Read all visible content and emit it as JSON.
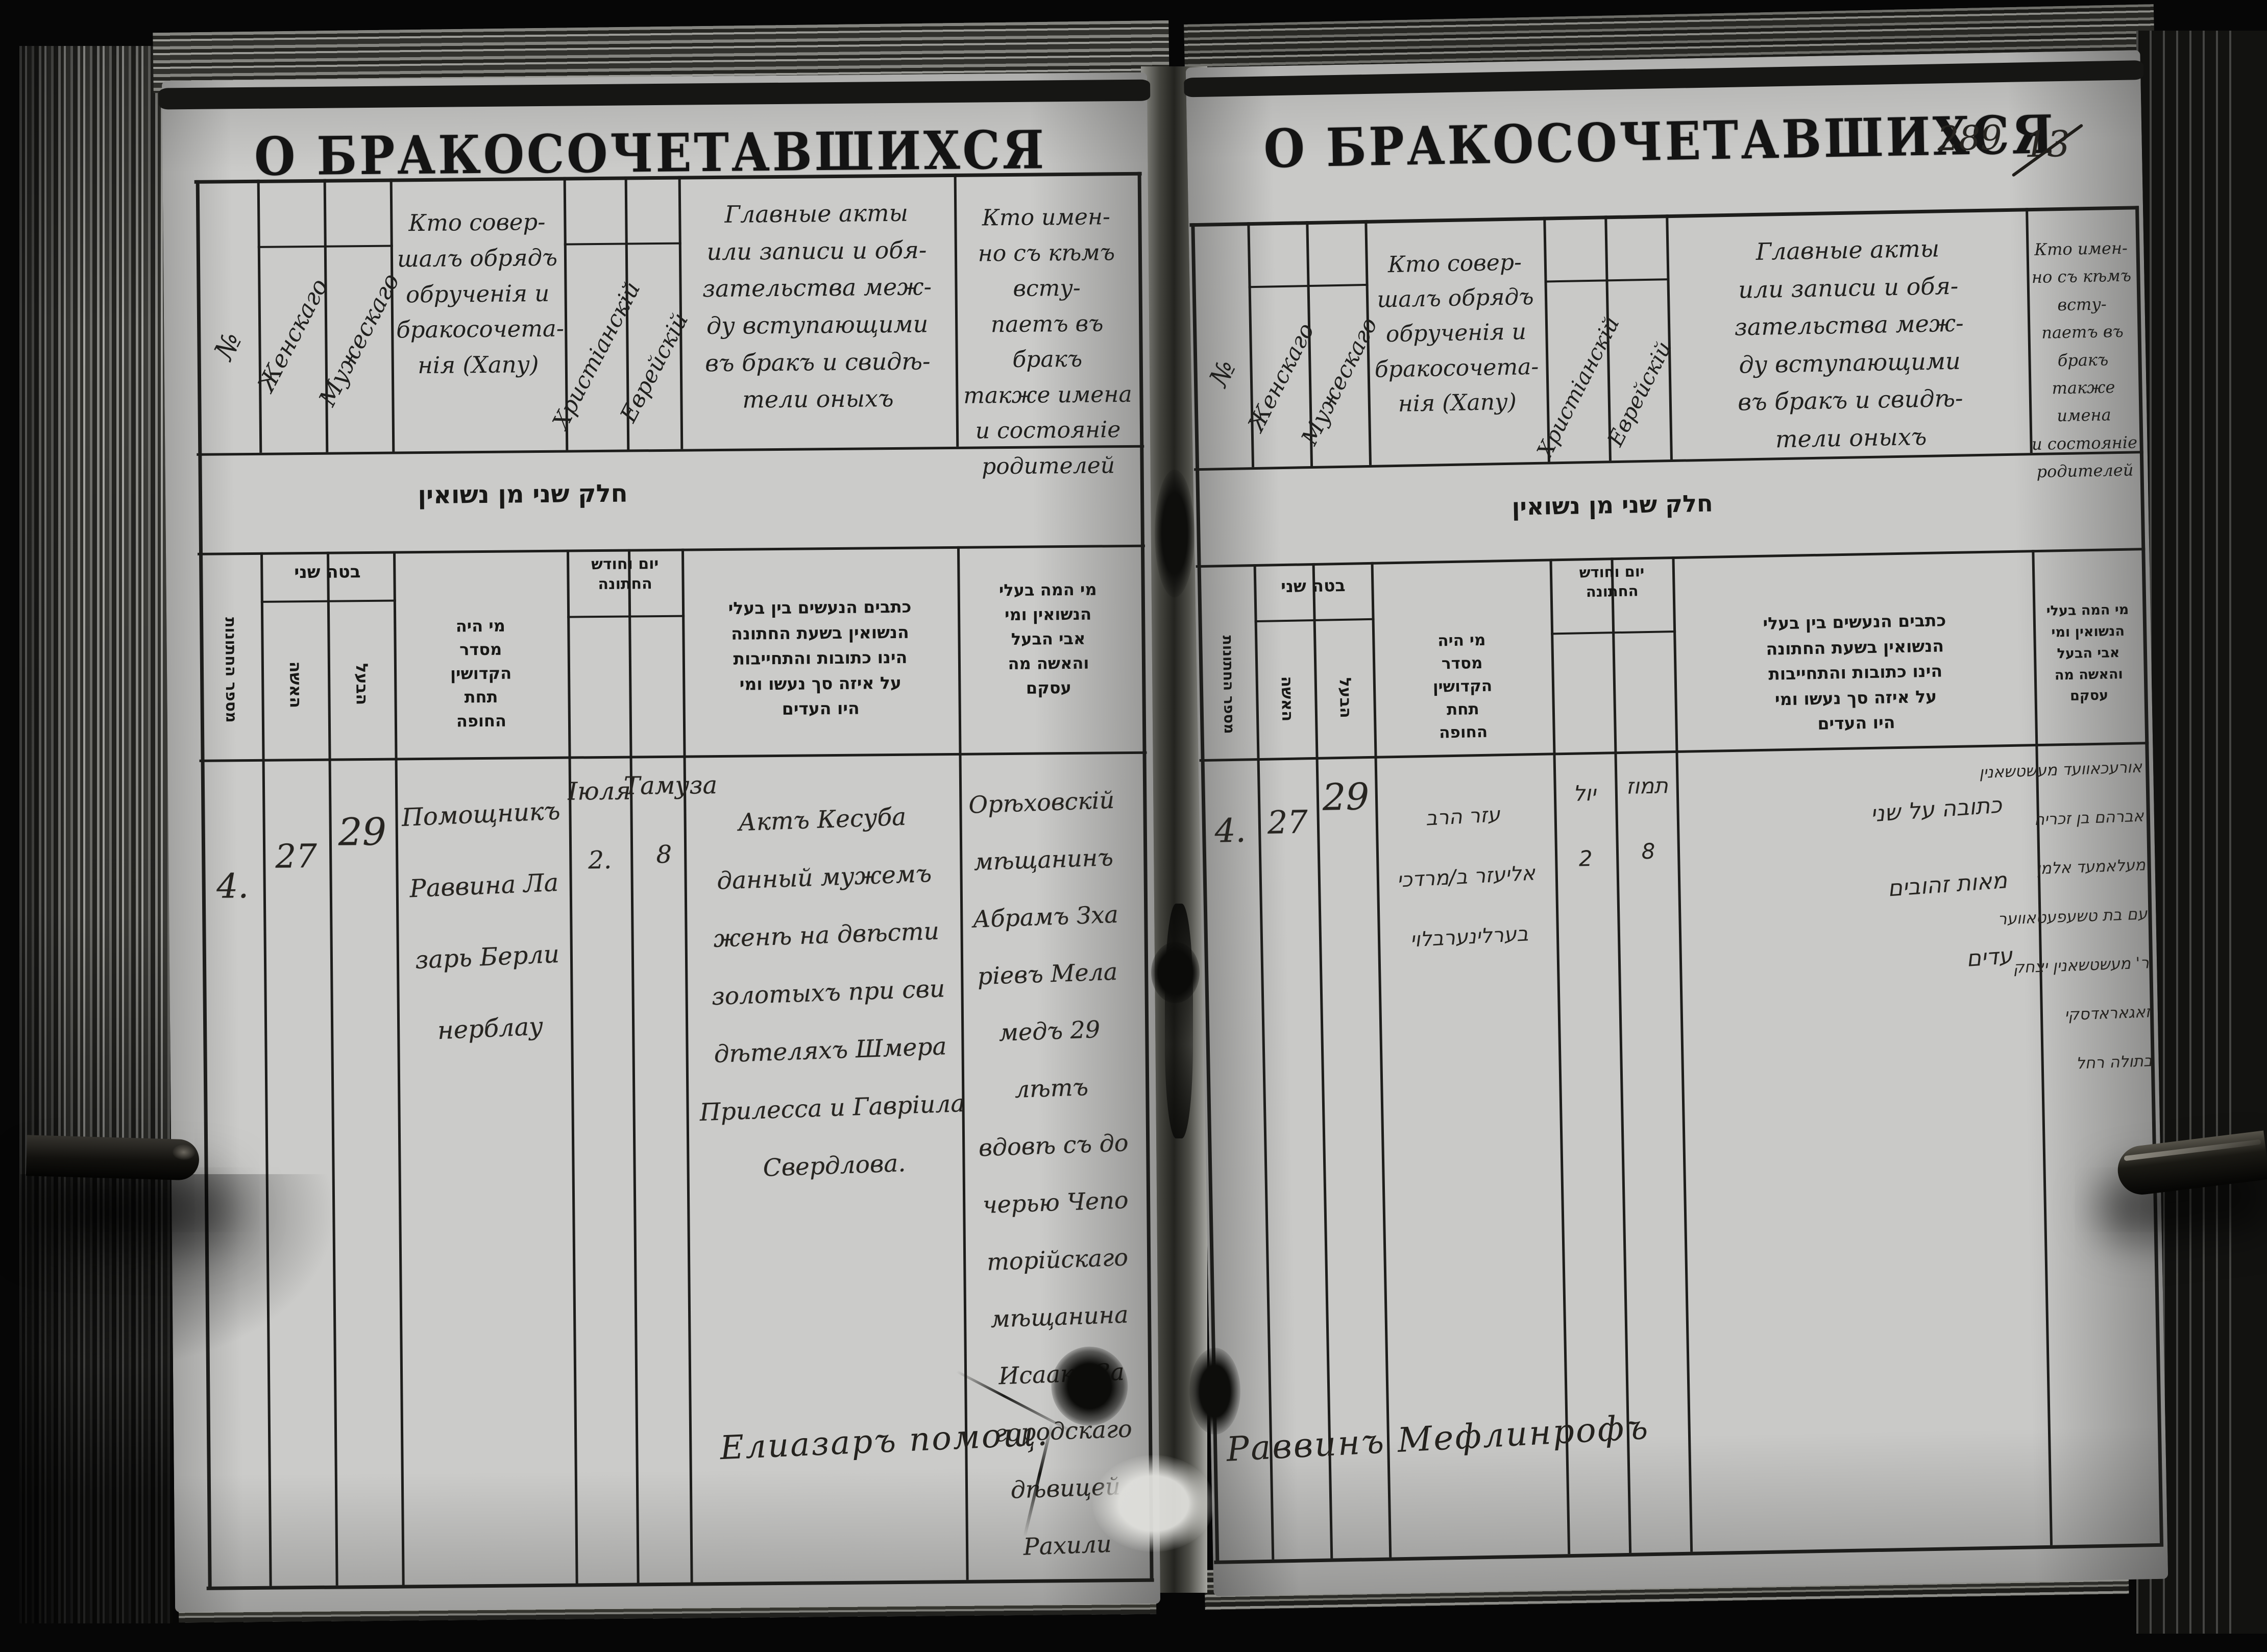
{
  "scan": {
    "title": "О БРАКОСОЧЕТАВШИХСЯ",
    "page_number": "289",
    "page_number_struck": "13"
  },
  "headers": {
    "ru": {
      "no": "№",
      "female": "Женскаго",
      "male": "Мужескаго",
      "officiant": "Кто совер-\nшалъ обрядъ\nобрученія и\nбракосочета-\nнія (Хапу)",
      "christian": "Христіанскій",
      "jewish": "Еврейскій",
      "acts": "Главные акты\nили записи и обя-\nзательства меж-\nду вступающими\nвъ бракъ и свидѣ-\nтели оныхъ",
      "who": "Кто имен-\nно съ кѣмъ всту-\nпаетъ въ бракъ\nтакже имена\nи состояніе\nродителей"
    },
    "he": {
      "band": "חלק שני מן נשואין",
      "count": "מספר החתונות",
      "age": "בטה שני",
      "wife": "האשה",
      "husband": "הבעל",
      "officiant": "מי היה\nמסדר\nהקדושין\nתחת\nהחופה",
      "date": "יום וחודש\nהחתונה",
      "acts": "כתבים הנעשים בין בעלי\nהנשואין בשעת החתונה\nהינו כתובות והתחייבות\nעל איזה סך נעשו ומי\nהיו העדים",
      "who": "מי המה בעלי\nהנשואין ומי\nאבי הבעל\nוהאשה מה\nעסקם"
    }
  },
  "left_page": {
    "row": {
      "no": "4.",
      "bride_age": "27",
      "groom_age": "29",
      "officiant": "Помощникъ\nРаввина Ла\nзарь Берли\nнерблау",
      "date_christian": "Іюля\n2.",
      "date_jewish": "Тамуза\n8",
      "acts": "Актъ Кесуба\nданный мужемъ\nженѣ на двѣсти\nзолотыхъ при сви\nдѣтеляхъ Шмера\nПрилесса и Гавріила\nСвердлова.",
      "who": "Орѣховскій\nмѣщанинъ\nАбрамъ Зха\nріевъ Мела\nмедъ 29 лѣтъ\nвдовѣ съ до\nчерью Чепо\nторійскаго\nмѣщанина\nИсаака За\nгородскаго\nдѣвицей\nРахили"
    },
    "signature": "Елиазаръ помощ."
  },
  "right_page": {
    "row": {
      "no": "4.",
      "bride_age": "27",
      "groom_age": "29",
      "officiant": "עזר הרב\nאליעזר ב/מרדכי\nבערלינערבלוי",
      "date_christian": "יול\n2",
      "date_jewish": "תמוז\n8",
      "acts": "כתובה על שני\nמאות זהובים\nעדים",
      "who": "אורעכאוועד מעשטשאנין\nאברהם בן זכריה\nמעלאמעד אלמן\nעם בת טשעפעטאווער\nר' מעשטשאנין יצחק\nזאגאראדסקי\nבתולה רחל"
    },
    "signature": "Раввинъ Мефлинрофъ"
  }
}
